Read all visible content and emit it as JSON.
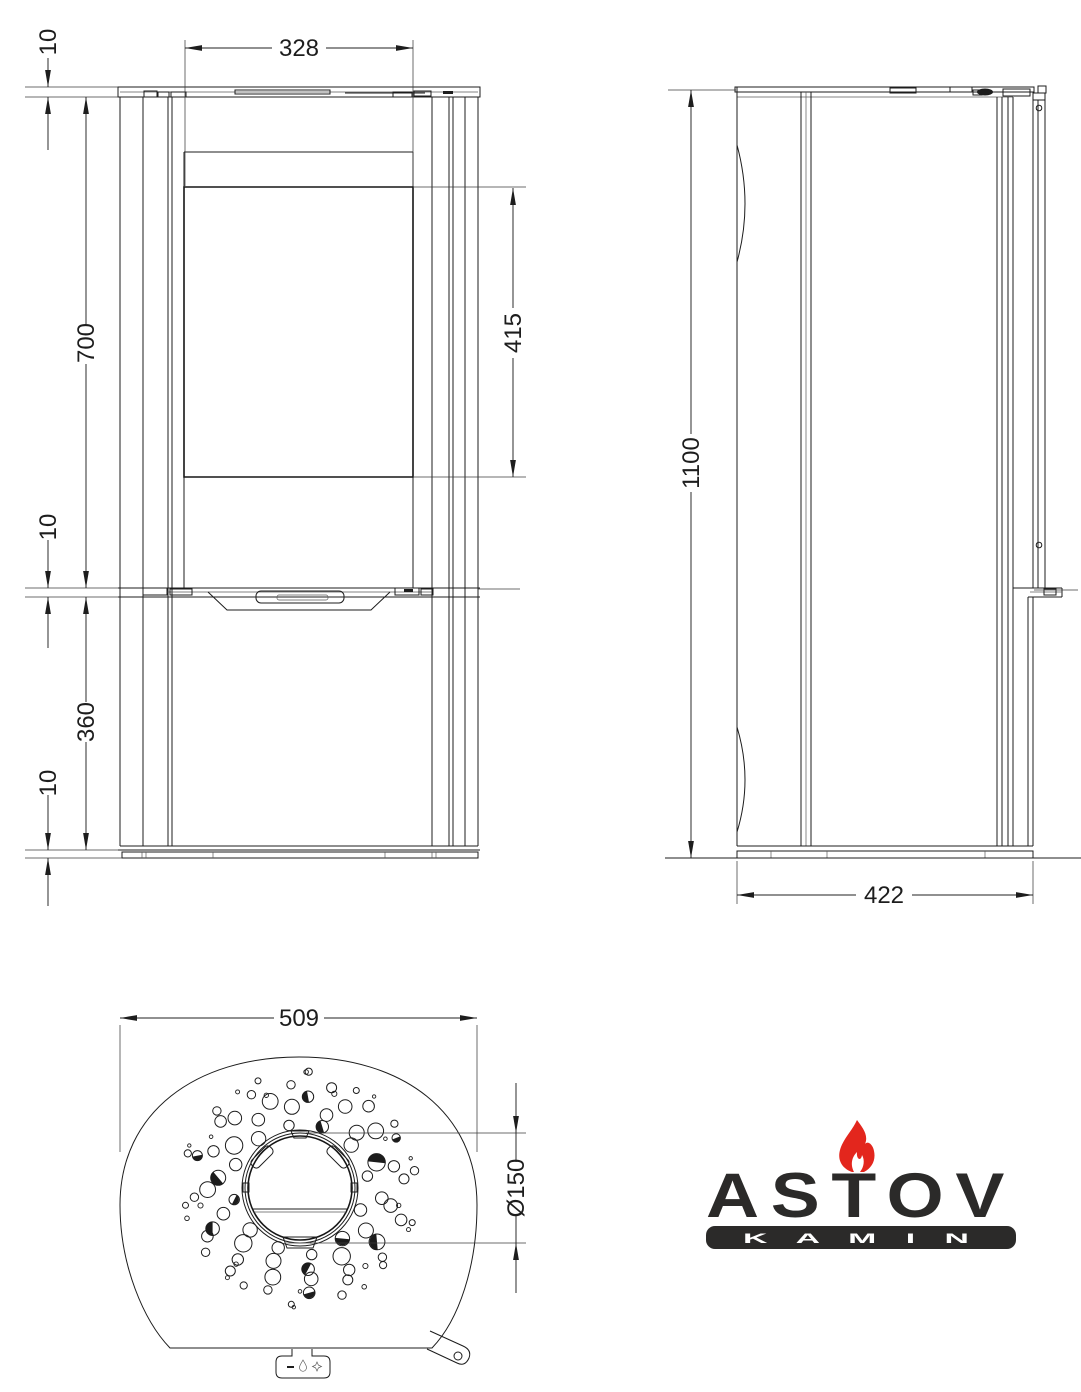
{
  "title": "Stove dimensional drawing",
  "views": {
    "front": {
      "dims": {
        "top_plate": "10",
        "upper_section": "700",
        "shelf": "10",
        "lower_section": "360",
        "base": "10",
        "glass_width": "328",
        "glass_height": "415"
      }
    },
    "side": {
      "dims": {
        "height": "1100",
        "depth": "422"
      }
    },
    "plan": {
      "dims": {
        "width": "509",
        "flue": "Ø150"
      },
      "hole_pattern": {
        "center": [
          300,
          1188
        ],
        "rings": [
          {
            "r": 66,
            "n": 12,
            "hr": 6.2,
            "a0": -100,
            "hatch_every": 4,
            "hatch_off": 1
          },
          {
            "r": 80,
            "n": 14,
            "hr": 7.5,
            "a0": -70,
            "hatch_every": 4,
            "hatch_off": 2
          },
          {
            "r": 94,
            "n": 15,
            "hr": 6.8,
            "a0": -85,
            "hatch_every": 5,
            "hatch_off": 0
          },
          {
            "r": 106,
            "n": 16,
            "hr": 5.0,
            "a0": -95,
            "hatch_every": 5,
            "hatch_off": 3
          },
          {
            "r": 115,
            "n": 14,
            "hr": 3.6,
            "a0": -60,
            "hatch_every": 0,
            "hatch_off": 0
          },
          {
            "r": 101,
            "n": 9,
            "hr": 2.2,
            "a0": -30,
            "hatch_every": 0,
            "hatch_off": 0
          },
          {
            "r": 117,
            "n": 10,
            "hr": 2.0,
            "a0": -15,
            "hatch_every": 0,
            "hatch_off": 0
          }
        ]
      }
    }
  },
  "logo": {
    "brand": "ASTOV",
    "subtitle": "K A M I N",
    "flame_color": "#e3261d",
    "text_color": "#2b2a29",
    "bar_text_color": "#ffffff"
  },
  "style": {
    "line_color": "#1c1c1c",
    "background": "#ffffff"
  }
}
